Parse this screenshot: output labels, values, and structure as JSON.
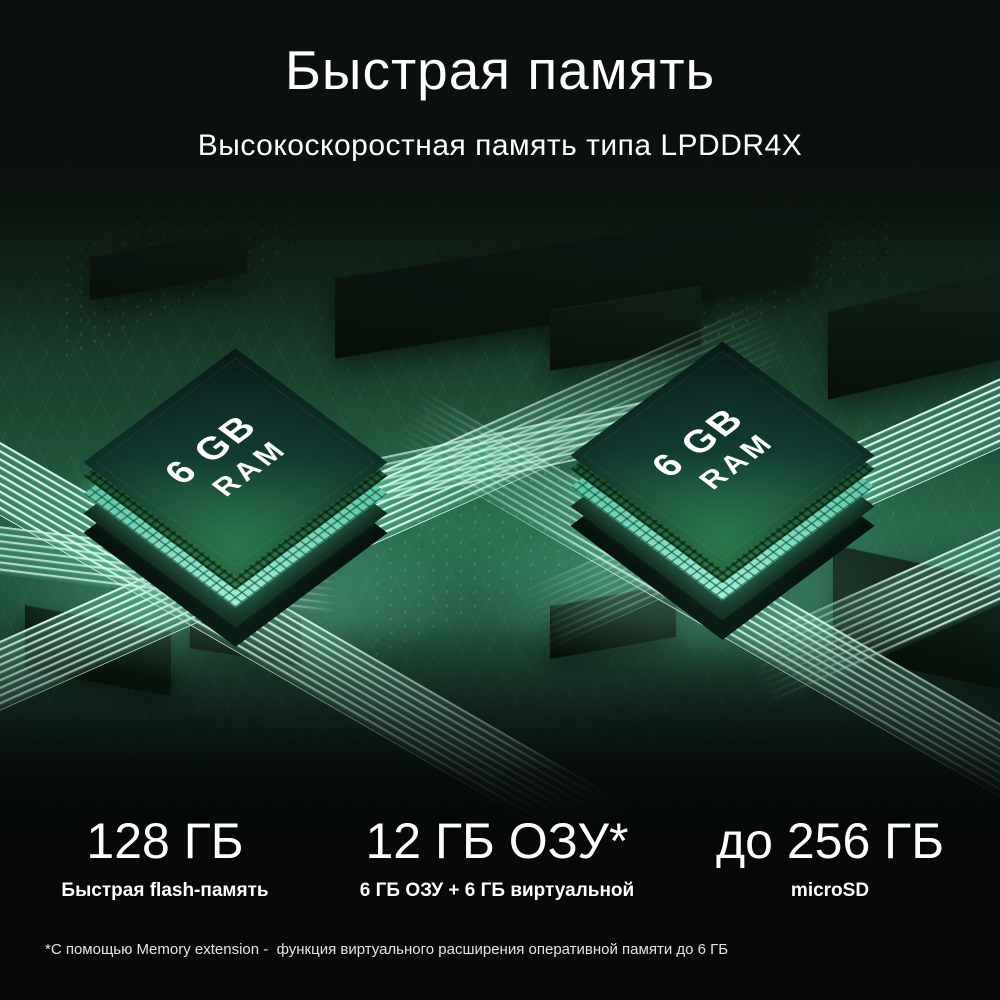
{
  "header": {
    "title": "Быстрая память",
    "subtitle": "Высокоскоростная память типа LPDDR4X"
  },
  "chips": {
    "left": {
      "capacity": "6 GB",
      "type": "RAM"
    },
    "right": {
      "capacity": "6 GB",
      "type": "RAM"
    }
  },
  "specs": [
    {
      "value": "128 ГБ",
      "label": "Быстрая flash-память"
    },
    {
      "value": "12 ГБ ОЗУ*",
      "label": "6 ГБ ОЗУ + 6 ГБ виртуальной"
    },
    {
      "value": "до 256 ГБ",
      "label": "microSD"
    }
  ],
  "footnote": "*С помощью Memory extension -  функция виртуального расширения оперативной памяти до 6 ГБ",
  "colors": {
    "background": "#0b100c",
    "board_green": "#236044",
    "glow_teal": "#9ff0d6",
    "chip_face_dark": "#0a211d",
    "chip_face_green": "#2e7d50",
    "text": "#ffffff"
  }
}
